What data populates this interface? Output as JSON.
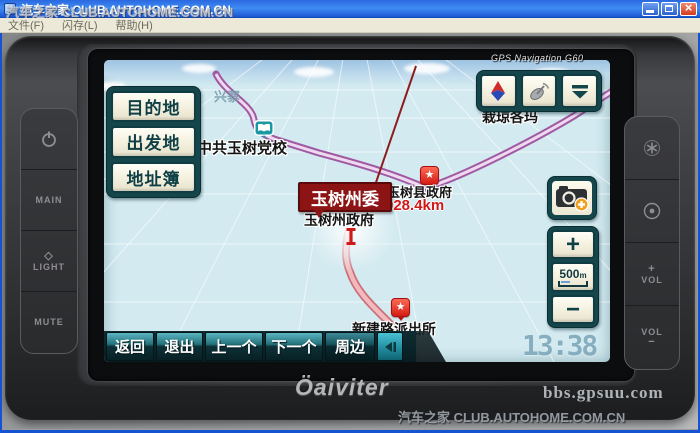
{
  "window": {
    "title": "汽车之家 CLUB.AUTOHOME.COM.CN",
    "watermark": "汽车之家 CLUB.AUTOHOME.COM.CN",
    "menu": [
      "文件(F)",
      "闪存(L)",
      "帮助(H)"
    ]
  },
  "photo": {
    "watermark_device": "bbs.gpsuu.com",
    "watermark_bottom": "汽车之家 CLUB.AUTOHOME.COM.CN"
  },
  "device": {
    "model_label": "GPS Navigation G60",
    "brand": "Öaiviter",
    "left_buttons": {
      "main": "MAIN",
      "light": "LIGHT",
      "mute": "MUTE"
    },
    "right_buttons": {
      "vol_up_sign": "+",
      "vol_up": "VOL",
      "vol_down": "VOL",
      "vol_down_sign": "−"
    }
  },
  "screen": {
    "nav_panel": [
      "目的地",
      "出发地",
      "地址簿"
    ],
    "zoom": {
      "plus": "+",
      "scale_value": "500",
      "scale_unit": "m",
      "minus": "−"
    },
    "bottom_bar": [
      "返回",
      "退出",
      "上一个",
      "下一个",
      "周边"
    ],
    "clock": "13:38",
    "map": {
      "region_label": "兴寨",
      "labels": {
        "school": "中共玉树党校",
        "village": "栽琼各玛",
        "county_gov": "玉树县政府",
        "selected": "玉树州委",
        "distance": "028.4km",
        "prefecture_gov": "玉树州政府",
        "police": "新建路派出所"
      }
    },
    "accent_colors": {
      "panel_teal": "#15464c",
      "button_cream": "#f4f0de",
      "selected_red": "#8c1414",
      "map_bg": "#d2eaf0"
    }
  }
}
